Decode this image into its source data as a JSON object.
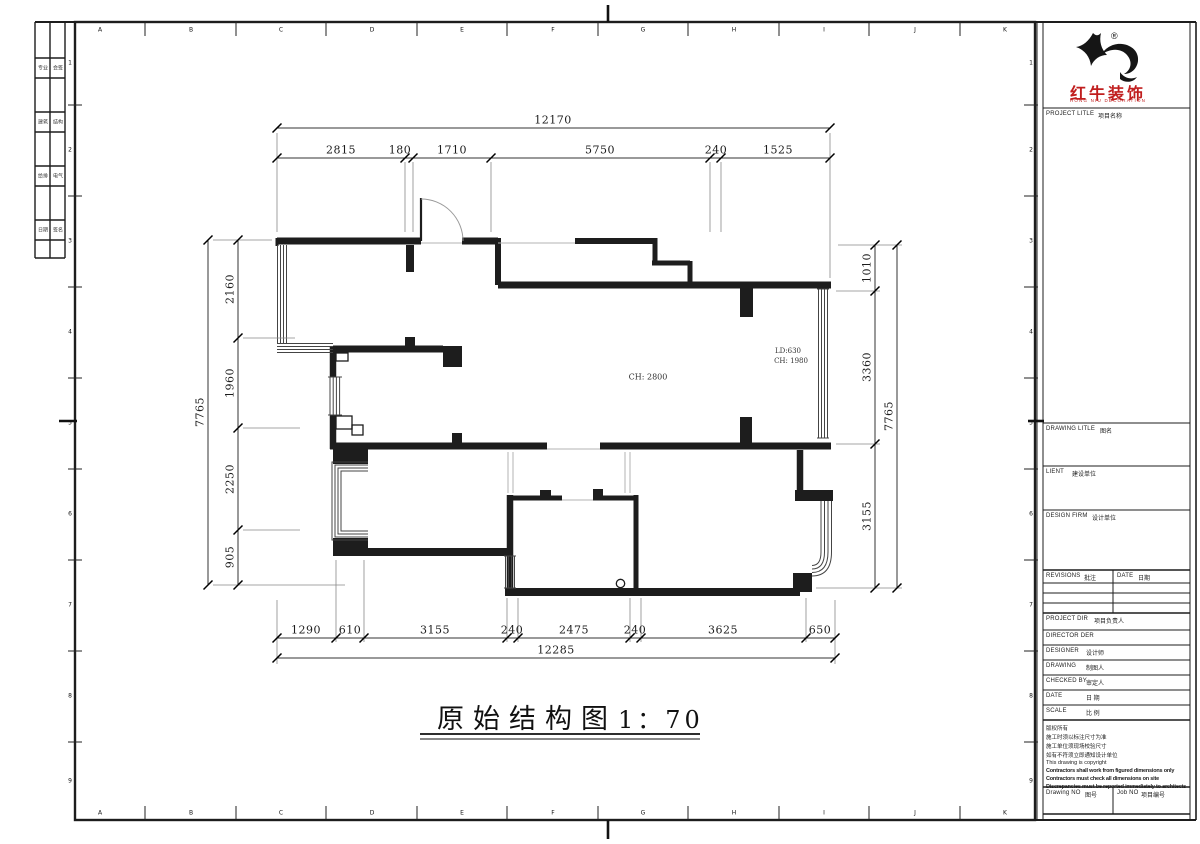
{
  "colors": {
    "line": "#1d1d1d",
    "muted_line": "#b3b3b3",
    "brand_red": "#c01e1e"
  },
  "grid": {
    "letters": [
      "A",
      "B",
      "C",
      "D",
      "E",
      "F",
      "G",
      "H",
      "I",
      "J",
      "K"
    ],
    "numbers": [
      "1",
      "2",
      "3",
      "4",
      "5",
      "6",
      "7",
      "8",
      "9"
    ]
  },
  "signature_strip": {
    "rows": [
      [
        "专业",
        "会签"
      ],
      [
        "建筑",
        "结构"
      ],
      [
        "给排",
        "电气"
      ],
      [
        "日期",
        "签名"
      ]
    ]
  },
  "dims": {
    "top": {
      "total": "12170",
      "segments": [
        "2815",
        "180",
        "1710",
        "5750",
        "240",
        "1525"
      ]
    },
    "bottom": {
      "total": "12285",
      "segments": [
        "1290",
        "610",
        "3155",
        "240",
        "2475",
        "240",
        "3625",
        "650"
      ]
    },
    "left": {
      "total": "7765",
      "segments": [
        "2160",
        "1960",
        "2250",
        "905"
      ]
    },
    "right": {
      "total": "7765",
      "segments": [
        "1010",
        "3360",
        "3155"
      ]
    }
  },
  "plan_labels": {
    "ch_living": "CH: 2800",
    "ld_right": "LD:630",
    "ch_right": "CH: 1980"
  },
  "drawing_title": {
    "name": "原始结构图",
    "scale": "1：70"
  },
  "title_block": {
    "logo": {
      "reg": "®",
      "brand": "红牛装饰",
      "brand_en": "HONG NIU DECORATION"
    },
    "project_title": {
      "en": "PROJECT LITLE",
      "cn": "项目名称"
    },
    "drawing_title": {
      "en": "DRAWING LITLE",
      "cn": "图名"
    },
    "client": {
      "en": "LIENT",
      "cn": "建设单位"
    },
    "design_firm": {
      "en": "DESIGN FIRM",
      "cn": "设计单位"
    },
    "revisions": {
      "en": "REVISIONS",
      "cn": "批注"
    },
    "date_col": {
      "en": "DATE",
      "cn": "日期"
    },
    "project_dir": {
      "en": "PROJECT DIR",
      "cn": "项目负责人"
    },
    "director": {
      "en": "DIRECTOR DER"
    },
    "designer": {
      "en": "DESIGNER",
      "cn": "设计师"
    },
    "drawing_by": {
      "en": "DRAWING",
      "cn": "制图人"
    },
    "checked_by": {
      "en": "CHECKED BY",
      "cn": "审定人"
    },
    "date_row": {
      "en": "DATE",
      "cn": "日 期"
    },
    "scale_row": {
      "en": "SCALE",
      "cn": "比 例"
    },
    "notes_cn": [
      "版权所有",
      "施工时须以标注尺寸为准",
      "施工单位须现场校验尺寸",
      "如有不符须立即通知设计单位"
    ],
    "notes_en": [
      "This drawing is copyright",
      "Contractors shall work from figured dimensions only",
      "Contractors must check all dimensions on site",
      "Discrepancies must be reported immediately to architects"
    ],
    "drawing_no": {
      "en": "Drawing NO",
      "cn": "图号"
    },
    "job_no": {
      "en": "Job NO",
      "cn": "项目编号"
    }
  }
}
